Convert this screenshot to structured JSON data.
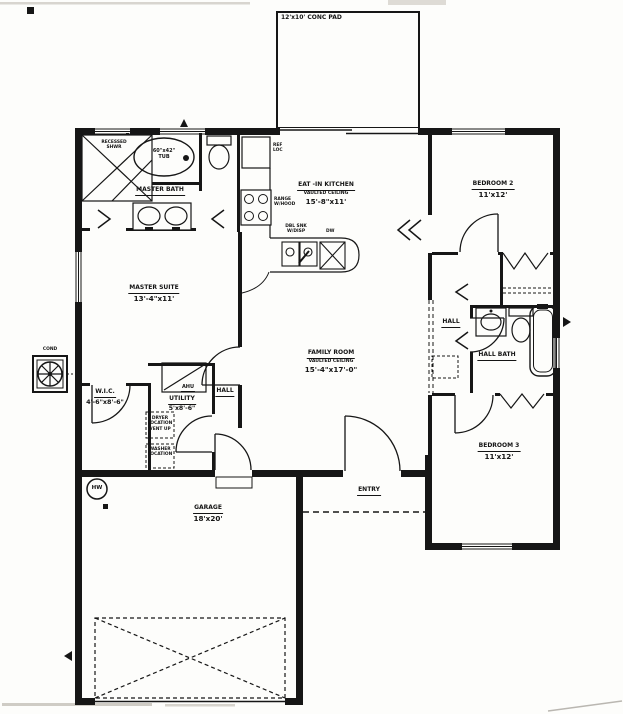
{
  "colors": {
    "ink": "#161616",
    "paper": "#fdfdfb"
  },
  "plan": {
    "conc_pad_label": "12'x10' CONC PAD",
    "rooms": {
      "master_bath": {
        "name": "MASTER BATH"
      },
      "master_suite": {
        "name": "MASTER SUITE",
        "dims": "13'-4\"x11'"
      },
      "kitchen": {
        "name": "EAT -IN KITCHEN",
        "note": "VAULTED CEILING",
        "dims": "15'-8\"x11'"
      },
      "family_room": {
        "name": "FAMILY ROOM",
        "note": "VAULTED CEILING",
        "dims": "15'-4\"x17'-0\""
      },
      "bedroom_2": {
        "name": "BEDROOM 2",
        "dims": "11'x12'"
      },
      "bedroom_3": {
        "name": "BEDROOM 3",
        "dims": "11'x12'"
      },
      "hall_right": {
        "name": "HALL"
      },
      "hall_bath": {
        "name": "HALL BATH"
      },
      "hall_left": {
        "name": "HALL"
      },
      "wic": {
        "name": "W.I.C.",
        "dims": "4'-6\"x8'-6\""
      },
      "utility": {
        "name": "UTILITY",
        "dims": "5'x8'-6\""
      },
      "entry": {
        "name": "ENTRY"
      },
      "garage": {
        "name": "GARAGE",
        "dims": "18'x20'"
      }
    },
    "fixtures": {
      "recessed_shower": "RECESSED\nSHWR",
      "tub": "60\"x42\"\nTUB",
      "ref_loc": "REF\nLOC",
      "range": "RANGE\nW/HOOD",
      "dbl_sink": "DBL SNK\nW/DISP",
      "dishwasher": "DW",
      "ahu": "AHU",
      "dryer": "DRYER\nLOCATION\nVENT UP",
      "washer": "WASHER\nLOCATION",
      "water_heater": "HW",
      "condenser": "COND"
    }
  }
}
